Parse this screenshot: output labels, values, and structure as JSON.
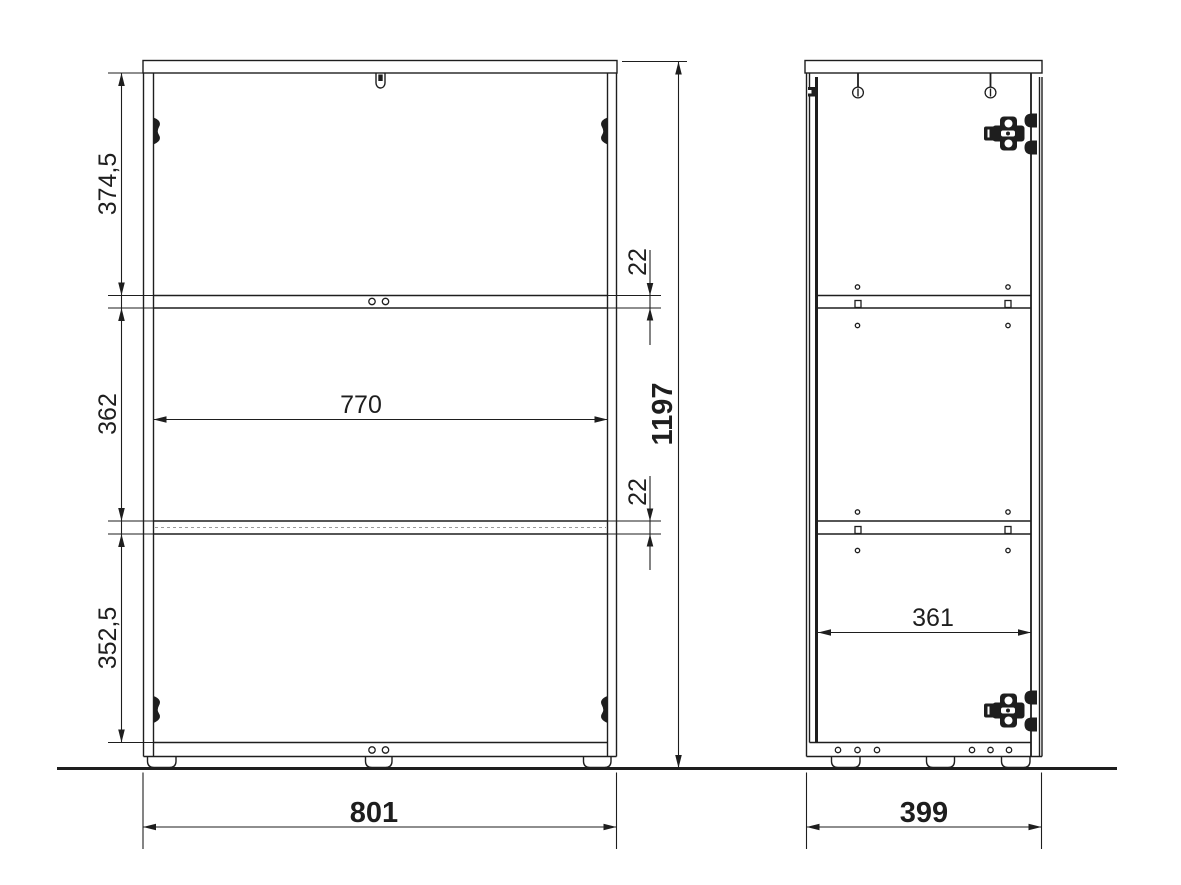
{
  "drawing": {
    "dimensions_mm": {
      "overall_height": "1197",
      "overall_width": "801",
      "overall_depth": "399",
      "interior_width": "770",
      "interior_depth": "361",
      "upper_compartment_height": "374,5",
      "middle_compartment_height": "362",
      "lower_compartment_height": "352,5",
      "upper_shelf_thickness": "22",
      "lower_shelf_thickness": "22"
    },
    "colors": {
      "line": "#1e1e1e",
      "background": "#ffffff",
      "dashed_line": "#9a9a9a"
    }
  }
}
